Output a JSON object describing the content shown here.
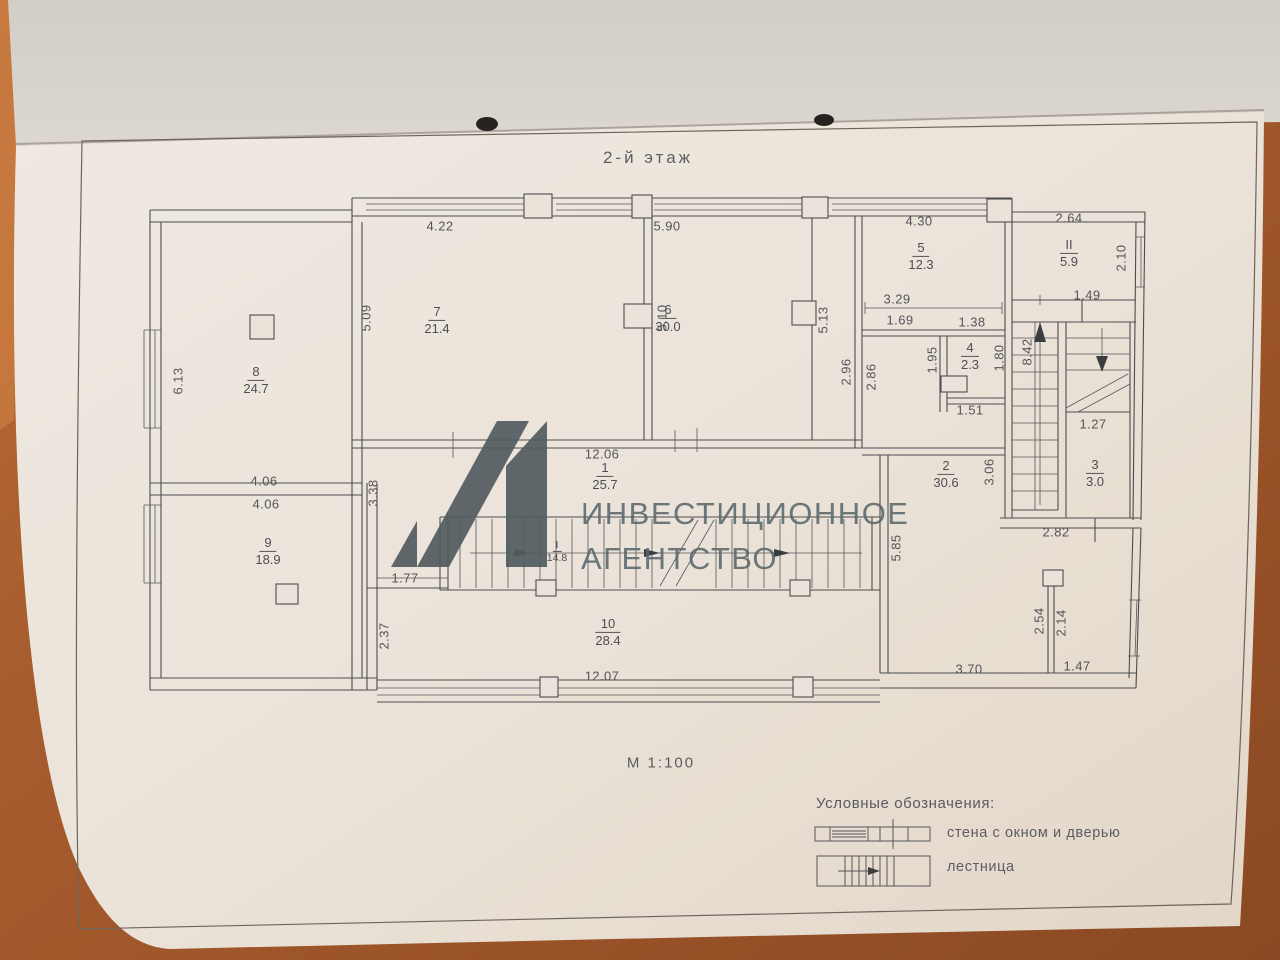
{
  "title": "2-й этаж",
  "scale_label": "М 1:100",
  "watermark": {
    "logo": "А1",
    "line1": "ИНВЕСТИЦИОННОЕ",
    "line2": "АГЕНТСТВО"
  },
  "legend": {
    "heading": "Условные обозначения:",
    "items": [
      {
        "symbol": "wall-with-window-and-door",
        "label": "стена с окном и дверью"
      },
      {
        "symbol": "staircase",
        "label": "лестница"
      }
    ]
  },
  "plan": {
    "rooms": [
      {
        "num": "1",
        "den": "25.7",
        "x": 605,
        "y": 477
      },
      {
        "num": "2",
        "den": "30.6",
        "x": 946,
        "y": 475
      },
      {
        "num": "3",
        "den": "3.0",
        "x": 1095,
        "y": 474
      },
      {
        "num": "4",
        "den": "2.3",
        "x": 970,
        "y": 357
      },
      {
        "num": "5",
        "den": "12.3",
        "x": 921,
        "y": 257
      },
      {
        "num": "6",
        "den": "30.0",
        "x": 668,
        "y": 319
      },
      {
        "num": "7",
        "den": "21.4",
        "x": 437,
        "y": 321
      },
      {
        "num": "8",
        "den": "24.7",
        "x": 256,
        "y": 381
      },
      {
        "num": "9",
        "den": "18.9",
        "x": 268,
        "y": 552
      },
      {
        "num": "10",
        "den": "28.4",
        "x": 608,
        "y": 633
      },
      {
        "num": "I",
        "den": "14.8",
        "x": 557,
        "y": 552,
        "small": true
      },
      {
        "num": "II",
        "den": "5.9",
        "x": 1069,
        "y": 254
      }
    ],
    "dims": [
      {
        "t": "4.22",
        "x": 440,
        "y": 226
      },
      {
        "t": "5.90",
        "x": 667,
        "y": 226
      },
      {
        "t": "4.30",
        "x": 919,
        "y": 221
      },
      {
        "t": "2.64",
        "x": 1069,
        "y": 218
      },
      {
        "t": "5.09",
        "x": 366,
        "y": 318,
        "rot": true
      },
      {
        "t": "5.10",
        "x": 662,
        "y": 318,
        "rot": true
      },
      {
        "t": "5.13",
        "x": 823,
        "y": 320,
        "rot": true
      },
      {
        "t": "2.10",
        "x": 1121,
        "y": 258,
        "rot": true
      },
      {
        "t": "6.13",
        "x": 178,
        "y": 381,
        "rot": true
      },
      {
        "t": "1.49",
        "x": 1087,
        "y": 295
      },
      {
        "t": "3.29",
        "x": 897,
        "y": 299
      },
      {
        "t": "1.69",
        "x": 900,
        "y": 320
      },
      {
        "t": "1.38",
        "x": 972,
        "y": 322
      },
      {
        "t": "1.95",
        "x": 932,
        "y": 360,
        "rot": true
      },
      {
        "t": "1.80",
        "x": 999,
        "y": 358,
        "rot": true
      },
      {
        "t": "8.42",
        "x": 1027,
        "y": 352,
        "rot": true
      },
      {
        "t": "2.96",
        "x": 846,
        "y": 372,
        "rot": true
      },
      {
        "t": "2.86",
        "x": 871,
        "y": 377,
        "rot": true
      },
      {
        "t": "1.51",
        "x": 970,
        "y": 410
      },
      {
        "t": "12.06",
        "x": 602,
        "y": 454
      },
      {
        "t": "3.38",
        "x": 373,
        "y": 493,
        "rot": true
      },
      {
        "t": "4.06",
        "x": 264,
        "y": 481
      },
      {
        "t": "4.06",
        "x": 266,
        "y": 504
      },
      {
        "t": "1.27",
        "x": 1093,
        "y": 424
      },
      {
        "t": "3.06",
        "x": 989,
        "y": 472,
        "rot": true
      },
      {
        "t": "2.82",
        "x": 1056,
        "y": 532
      },
      {
        "t": "5.85",
        "x": 896,
        "y": 548,
        "rot": true
      },
      {
        "t": "1.77",
        "x": 405,
        "y": 578
      },
      {
        "t": "2.37",
        "x": 384,
        "y": 636,
        "rot": true
      },
      {
        "t": "12.07",
        "x": 602,
        "y": 676
      },
      {
        "t": "3.70",
        "x": 969,
        "y": 669
      },
      {
        "t": "2.54",
        "x": 1039,
        "y": 621,
        "rot": true
      },
      {
        "t": "2.14",
        "x": 1061,
        "y": 623,
        "rot": true
      },
      {
        "t": "1.47",
        "x": 1077,
        "y": 666
      }
    ]
  },
  "colors": {
    "wood": "#a75d2e",
    "paper": "#ece4da",
    "ink": "#4b4c50",
    "watermark": "#5a666b"
  }
}
